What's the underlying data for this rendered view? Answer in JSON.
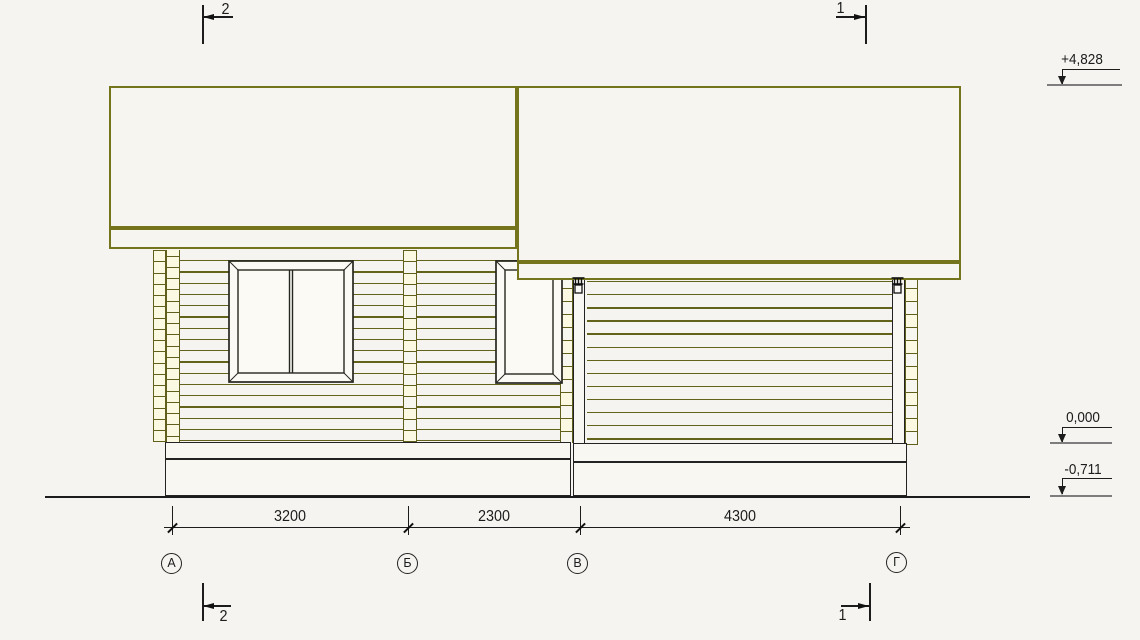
{
  "section_marks": {
    "top_left": "2",
    "top_right": "1",
    "bottom_left": "2",
    "bottom_right": "1"
  },
  "elevation_marks": [
    {
      "label": "+4,828"
    },
    {
      "label": "0,000"
    },
    {
      "label": "-0,711"
    }
  ],
  "dimensions": [
    {
      "label": "3200"
    },
    {
      "label": "2300"
    },
    {
      "label": "4300"
    }
  ],
  "axes": [
    {
      "label": "А"
    },
    {
      "label": "Б"
    },
    {
      "label": "В"
    },
    {
      "label": "Г"
    }
  ],
  "colors": {
    "line_olive": "#62621a",
    "roof_stroke": "#74741c",
    "line_black": "#1c1c1c",
    "level_gray": "#7d7d7d",
    "log_fill": "#fcf9e3",
    "background": "#f5f4f0"
  }
}
